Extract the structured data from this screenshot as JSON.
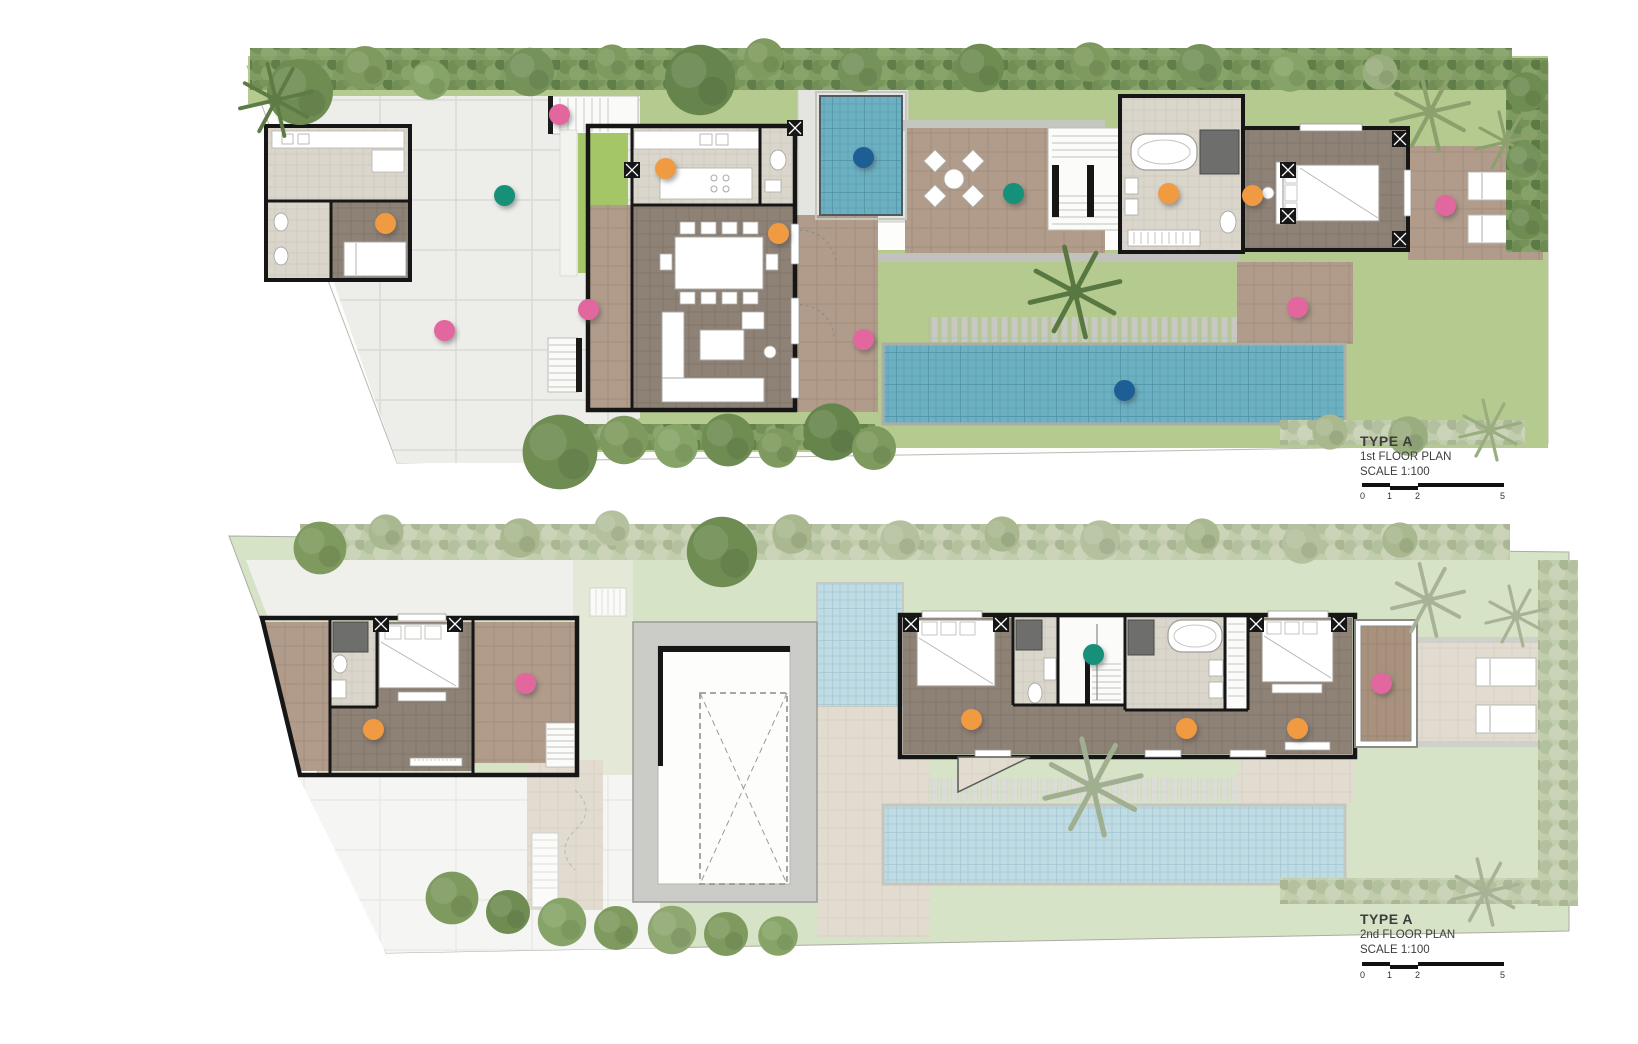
{
  "floors": [
    {
      "name": "TYPE A",
      "plan": "1st FLOOR PLAN",
      "scale": "SCALE 1:100",
      "scale_ticks": [
        "0",
        "1",
        "2",
        "5"
      ]
    },
    {
      "name": "TYPE A",
      "plan": "2nd FLOOR PLAN",
      "scale": "SCALE 1:100",
      "scale_ticks": [
        "0",
        "1",
        "2",
        "5"
      ]
    }
  ],
  "marker_colors": {
    "pink": "#E2679E",
    "orange": "#F09A41",
    "teal": "#17907A",
    "blue": "#1D5F94"
  },
  "markers": [
    {
      "floor": 1,
      "area": "entry-steps",
      "color": "pink",
      "x": 559,
      "y": 114
    },
    {
      "floor": 1,
      "area": "maid-room",
      "color": "orange",
      "x": 385,
      "y": 223
    },
    {
      "floor": 1,
      "area": "driveway-court",
      "color": "teal",
      "x": 504,
      "y": 195
    },
    {
      "floor": 1,
      "area": "driveway",
      "color": "pink",
      "x": 444,
      "y": 330
    },
    {
      "floor": 1,
      "area": "foyer",
      "color": "pink",
      "x": 588,
      "y": 309
    },
    {
      "floor": 1,
      "area": "kitchen",
      "color": "orange",
      "x": 665,
      "y": 168
    },
    {
      "floor": 1,
      "area": "dining",
      "color": "orange",
      "x": 778,
      "y": 233
    },
    {
      "floor": 1,
      "area": "spa-pool",
      "color": "blue",
      "x": 863,
      "y": 157
    },
    {
      "floor": 1,
      "area": "living-terrace",
      "color": "pink",
      "x": 863,
      "y": 339
    },
    {
      "floor": 1,
      "area": "courtyard",
      "color": "teal",
      "x": 1013,
      "y": 193
    },
    {
      "floor": 1,
      "area": "bathroom-1",
      "color": "orange",
      "x": 1168,
      "y": 193
    },
    {
      "floor": 1,
      "area": "bedroom-1",
      "color": "orange",
      "x": 1252,
      "y": 195
    },
    {
      "floor": 1,
      "area": "bedroom-1-terrace",
      "color": "pink",
      "x": 1445,
      "y": 205
    },
    {
      "floor": 1,
      "area": "pool-deck",
      "color": "pink",
      "x": 1297,
      "y": 307
    },
    {
      "floor": 1,
      "area": "swimming-pool",
      "color": "blue",
      "x": 1124,
      "y": 390
    },
    {
      "floor": 2,
      "area": "bedroom-2-terrace",
      "color": "pink",
      "x": 525,
      "y": 683
    },
    {
      "floor": 2,
      "area": "bedroom-2",
      "color": "orange",
      "x": 373,
      "y": 729
    },
    {
      "floor": 2,
      "area": "stair-hall",
      "color": "teal",
      "x": 1093,
      "y": 654
    },
    {
      "floor": 2,
      "area": "bedroom-3",
      "color": "orange",
      "x": 971,
      "y": 719
    },
    {
      "floor": 2,
      "area": "corridor",
      "color": "orange",
      "x": 1186,
      "y": 728
    },
    {
      "floor": 2,
      "area": "master-bedroom",
      "color": "orange",
      "x": 1297,
      "y": 728
    },
    {
      "floor": 2,
      "area": "master-balcony",
      "color": "pink",
      "x": 1381,
      "y": 683
    }
  ]
}
